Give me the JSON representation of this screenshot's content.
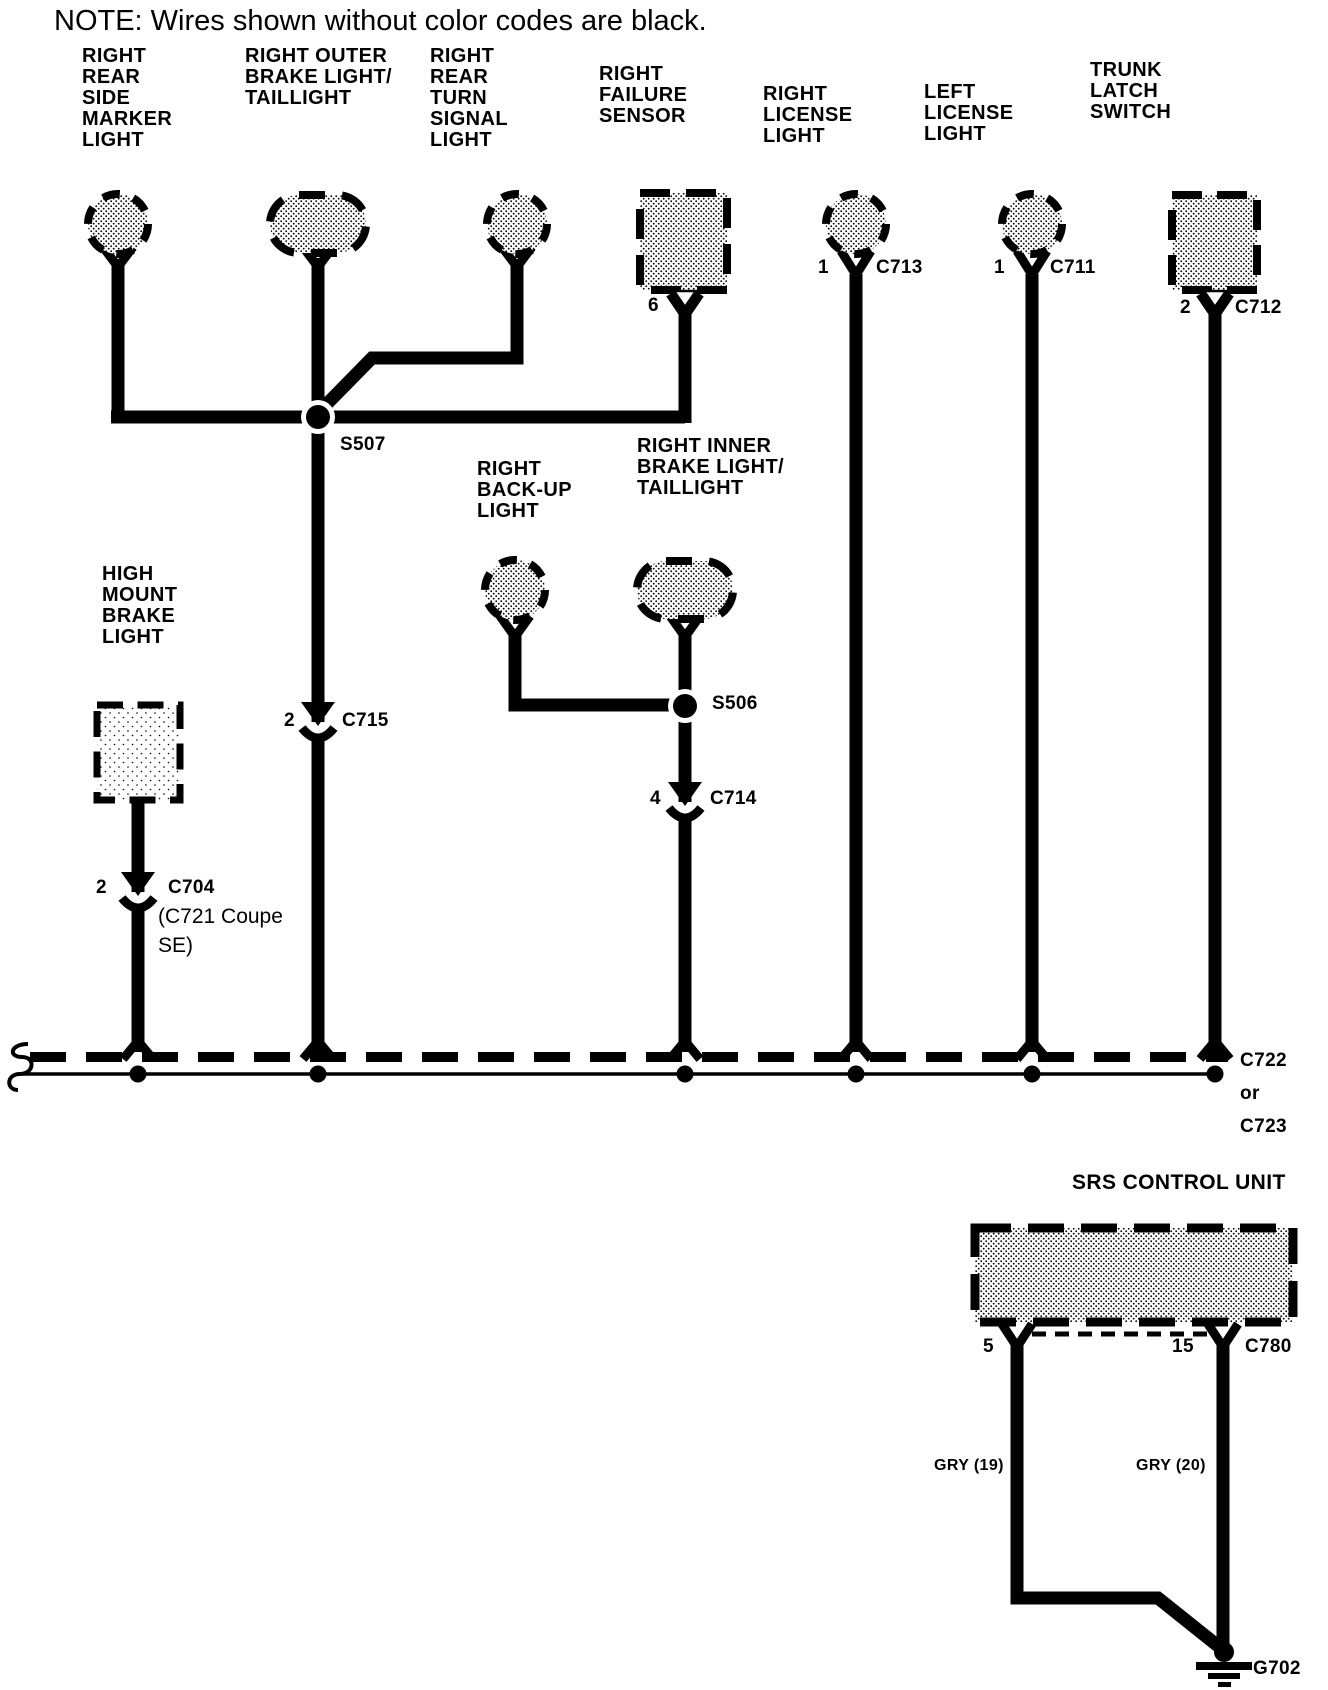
{
  "note": "NOTE: Wires shown without color codes are black.",
  "components": {
    "right_rear_side_marker_light": "RIGHT\nREAR\nSIDE\nMARKER\nLIGHT",
    "right_outer_brake_light": "RIGHT OUTER\nBRAKE LIGHT/\nTAILLIGHT",
    "right_rear_turn_signal_light": "RIGHT\nREAR\nTURN\nSIGNAL\nLIGHT",
    "right_failure_sensor": "RIGHT\nFAILURE\nSENSOR",
    "right_license_light": "RIGHT\nLICENSE\nLIGHT",
    "left_license_light": "LEFT\nLICENSE\nLIGHT",
    "trunk_latch_switch": "TRUNK\nLATCH\nSWITCH",
    "right_back_up_light": "RIGHT\nBACK-UP\nLIGHT",
    "right_inner_brake_light": "RIGHT INNER\nBRAKE LIGHT/\nTAILLIGHT",
    "high_mount_brake_light": "HIGH\nMOUNT\nBRAKE\nLIGHT",
    "srs_control_unit": "SRS CONTROL UNIT"
  },
  "splices": {
    "s507": "S507",
    "s506": "S506"
  },
  "connectors": {
    "c713": {
      "pin": "1",
      "name": "C713"
    },
    "c711": {
      "pin": "1",
      "name": "C711"
    },
    "c712": {
      "pin": "2",
      "name": "C712"
    },
    "c715": {
      "pin": "2",
      "name": "C715"
    },
    "c714": {
      "pin": "4",
      "name": "C714"
    },
    "c704": {
      "pin": "2",
      "name": "C704",
      "variant_note": "(C721 Coupe\nSE)"
    },
    "failure_sensor_pin": "6",
    "bus_label": "C722\nor\nC723",
    "c780": {
      "pin_left": "5",
      "pin_right": "15",
      "name": "C780"
    }
  },
  "wire_colors": {
    "gry_19": "GRY (19)",
    "gry_20": "GRY (20)"
  },
  "ground": {
    "name": "G702"
  },
  "colors": {
    "ink": "#000000",
    "paper": "#ffffff"
  }
}
